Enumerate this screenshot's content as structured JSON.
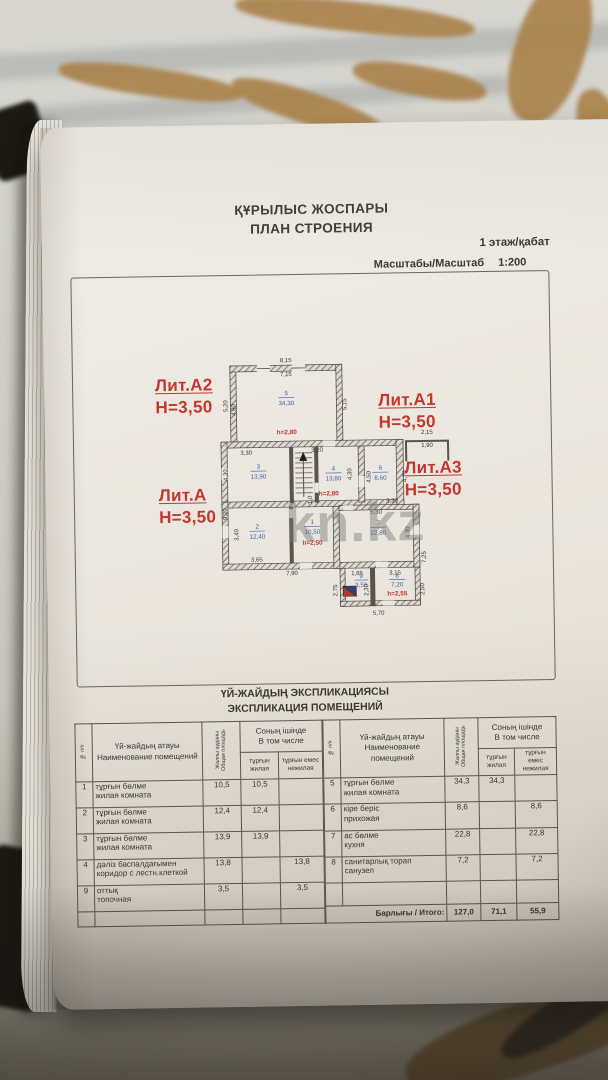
{
  "colors": {
    "stamp_red": "#c4372e",
    "room_blue": "#3c5fae",
    "watermark_gray": "#8e8c87",
    "ink": "#37332c"
  },
  "watermark": "kn.kz",
  "doc": {
    "title_kk": "ҚҰРЫЛЫС ЖОСПАРЫ",
    "title_ru": "ПЛАН СТРОЕНИЯ",
    "floor_label": "1 этаж/қабат",
    "scale_label": "Масштабы/Масштаб",
    "scale_value": "1:200"
  },
  "plan": {
    "lits": [
      {
        "name": "Лит.А2",
        "height": "Н=3,50"
      },
      {
        "name": "Лит.А1",
        "height": "Н=3,50"
      },
      {
        "name": "Лит.А3",
        "height": "Н=3,50"
      },
      {
        "name": "Лит.А",
        "height": "Н=3,50"
      }
    ],
    "rooms": {
      "r5": {
        "num": "5",
        "area": "34,30"
      },
      "r3": {
        "num": "3",
        "area": "13,90"
      },
      "r4": {
        "num": "4",
        "area": "13,80"
      },
      "r6": {
        "num": "6",
        "area": "8,60"
      },
      "r2": {
        "num": "2",
        "area": "12,40"
      },
      "r1": {
        "num": "1",
        "area": "10,50"
      },
      "r7": {
        "num": "7",
        "area": "22,80"
      },
      "r9": {
        "num": "9",
        "area": "3,50"
      },
      "r8": {
        "num": "8",
        "area": "7,20"
      }
    },
    "heights": {
      "h5": "h=2,80",
      "h4": "h=2,80",
      "h1": "h=2,50",
      "h8": "h=2,55"
    },
    "dims": {
      "top_out": "8,15",
      "top_in": "7,15",
      "r5_left_out": "5,20",
      "r5_left_in": "4,80",
      "r5_right": "5,15",
      "entry_w": "2,15",
      "entry_in": "1,90",
      "r3_top": "3,30",
      "hall_top": "3,20",
      "r3_left": "4,30",
      "r4_right": "4,30",
      "r6_left": "4,50",
      "r6_right": "4,70",
      "left_out": "9,20",
      "r2_left": "3,40",
      "r2_bottom": "3,65",
      "left_bottom": "7,90",
      "r7_top1": "5,30",
      "r7_top2": "3,30",
      "r7_right": "4,30",
      "right_out": "7,25",
      "r9_top": "1,65",
      "r8_top": "3,15",
      "annex_left": "2,75",
      "annex_mid": "2,30",
      "annex_right": "2,50",
      "annex_bottom": "5,70",
      "stair_w": "1,0"
    }
  },
  "table": {
    "title_kk": "ҮЙ-ЖАЙДЫҢ ЭКСПЛИКАЦИЯСЫ",
    "title_ru": "ЭКСПЛИКАЦИЯ ПОМЕЩЕНИЙ",
    "headers": {
      "num": "№ п/п",
      "name_kk": "Үй-жайдың атауы",
      "name_ru": "Наименование помещений",
      "total_kk": "Жалпы ауданы",
      "total_ru": "Общая площадь",
      "incl_kk": "Соның ішінде",
      "incl_ru": "В том числе",
      "living_kk": "тұрғын",
      "living_ru": "жилая",
      "nonliving_kk": "тұрғын емес",
      "nonliving_ru": "нежилая"
    },
    "left_rows": [
      {
        "num": "1",
        "name_kk": "тұрғын бөлме",
        "name_ru": "жилая комната",
        "total": "10,5",
        "living": "10,5",
        "nonliving": ""
      },
      {
        "num": "2",
        "name_kk": "тұрғын бөлме",
        "name_ru": "жилая комната",
        "total": "12,4",
        "living": "12,4",
        "nonliving": ""
      },
      {
        "num": "3",
        "name_kk": "тұрғын бөлме",
        "name_ru": "жилая комната",
        "total": "13,9",
        "living": "13,9",
        "nonliving": ""
      },
      {
        "num": "4",
        "name_kk": "дәліз баспалдағымен",
        "name_ru": "коридор с лестн.клеткой",
        "total": "13,8",
        "living": "",
        "nonliving": "13,8"
      },
      {
        "num": "9",
        "name_kk": "оттық",
        "name_ru": "топочная",
        "total": "3,5",
        "living": "",
        "nonliving": "3,5"
      }
    ],
    "right_rows": [
      {
        "num": "5",
        "name_kk": "тұрғын бөлме",
        "name_ru": "жилая комната",
        "total": "34,3",
        "living": "34,3",
        "nonliving": ""
      },
      {
        "num": "6",
        "name_kk": "кіре беріс",
        "name_ru": "прихожая",
        "total": "8,6",
        "living": "",
        "nonliving": "8,6"
      },
      {
        "num": "7",
        "name_kk": "ас бөлме",
        "name_ru": "кухня",
        "total": "22,8",
        "living": "",
        "nonliving": "22,8"
      },
      {
        "num": "8",
        "name_kk": "санитарлық торап",
        "name_ru": "санузел",
        "total": "7,2",
        "living": "",
        "nonliving": "7,2"
      }
    ],
    "total_label": "Барлығы / Итого:",
    "totals": {
      "total": "127,0",
      "living": "71,1",
      "nonliving": "55,9"
    }
  }
}
